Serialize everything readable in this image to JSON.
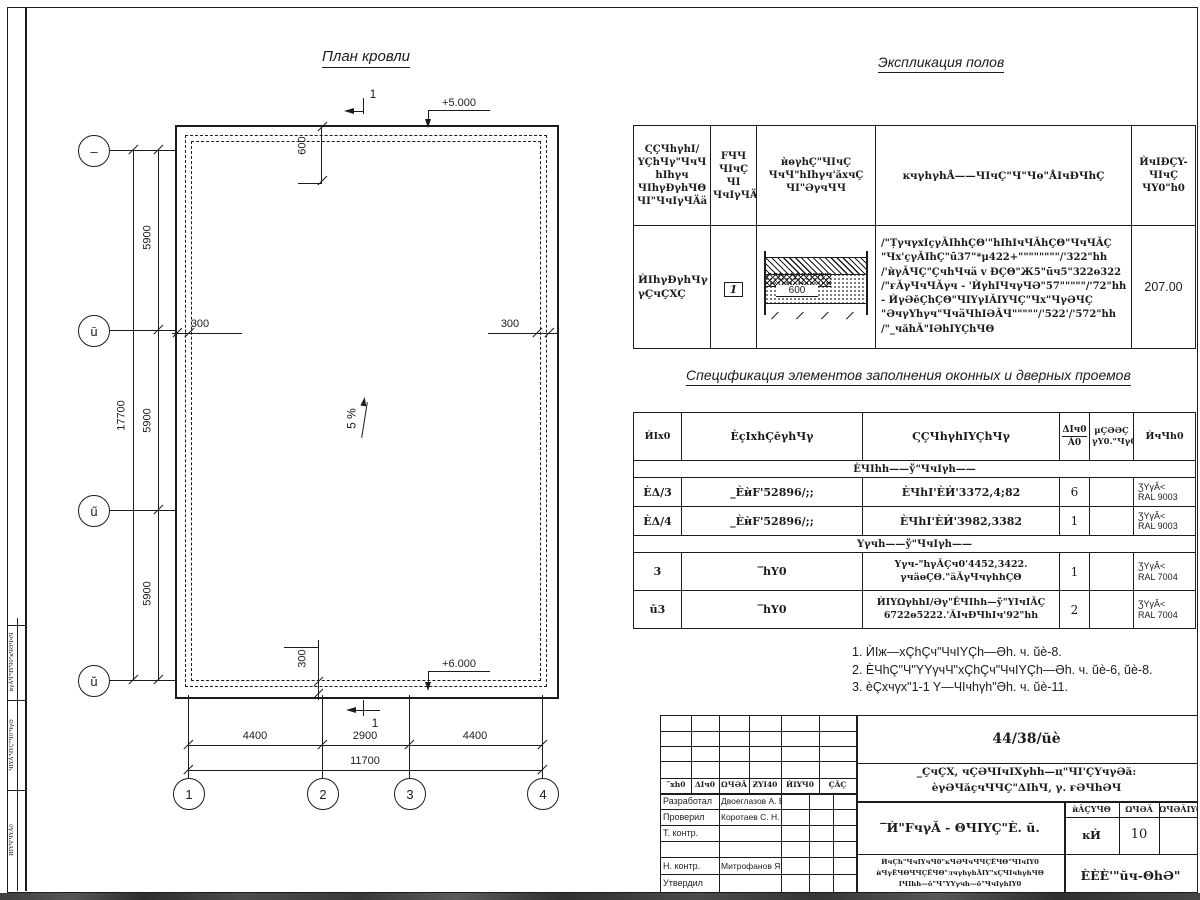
{
  "plan": {
    "title": "План кровли",
    "elev_top": "+5.000",
    "elev_bottom": "+6.000",
    "slope": "5 %",
    "sec_top": "1",
    "sec_bottom": "1",
    "dim600": "600",
    "dim300_left": "300",
    "dim300_right": "300",
    "dim300_bottom": "300",
    "left_dims": [
      "5900",
      "5900",
      "5900"
    ],
    "left_total": "17700",
    "bottom_dims": [
      "4400",
      "2900",
      "4400"
    ],
    "bottom_total": "11700",
    "axes_bottom": [
      "1",
      "2",
      "3",
      "4"
    ],
    "axes_left": [
      "–",
      "ū",
      "ű",
      "ŭ"
    ]
  },
  "explication": {
    "title": "Экспликация полов",
    "headers": {
      "c1": "ϚÇЧhγhI/\nYÇhЧγ\"ЧчЧ\nhIhγч\nЧIhγÐγhЧΘ\nЧI\"ЧчIγЧÄä",
      "c2": "FЧЧ\nЧIчÇ\nЧI\nЧчIγЧÄä",
      "c3": "ѝөγhÇ\"ЧIчÇ\nЧчЧ\"hIhγч'ăxчÇ\nЧI\"ƏγчЧЧ",
      "c4": "ĸчγhγhÅ——ЧIчÇ\"Ч\"Чө\"ÅIчÐЧhÇ",
      "c5": "ЍчIÐÇY-\nЧIчÇ\nЧY0\"h0"
    },
    "row": {
      "name": "ЍIhγÐγhЧγ\nγÇчÇXÇ",
      "num": "1",
      "sketch_dim": "600",
      "desc": "/\"ȚγчγxIçγǍIhhÇΘ'\"hIhIчЧǍhÇΘ\"ЧчЧǍÇ\n\"Чx'çγǍIhÇ\"ū37\"*μ422+\"\"\"\"\"\"\"\"/'322\"hh\n/'ѝγǍЧÇ\"ÇчhЧчä v ÐÇΘ\"Ж5\"ūч5\"322ө322\n/\"ғǍγЧчЧǍγч - 'ЍγhIЧчγЧƏ\"57\"\"\"\"\"/'72\"hh\n- ЍγƏĕÇhÇΘ\"ЧIYγIǍIYЧÇ\"Чx\"ЧγƏЧÇ\n\"ƏчγYhγч\"ЧчäЧhIƏǍЧ\"\"\"\"\"/'522'/'572\"hh\n/\"_чăhǍ\"IƏhIYÇhЧΘ",
      "area": "207.00"
    }
  },
  "spec": {
    "title": "Спецификация элементов заполнения оконных и дверных проемов",
    "headers": {
      "c1": "ЍIx0",
      "c2": "ÈçIxhÇĕγhЧγ",
      "c3": "ϚÇЧhγhIYÇhЧγ",
      "c4a": "ΔIч0",
      "c4b": "Ǎ0",
      "c5": "μÇƏƏÇ\nγY0.\"Чγ0",
      "c6": "ЍчЧh0"
    },
    "group1": "ÈЧIhh——ў\"ЧчIγh——",
    "group2": "Yγчh——ў\"ЧчIγh——",
    "rows": [
      {
        "mark": "ÈΔ/3",
        "doc": "_ÈѝF'52896/;;",
        "name": "ÈЧhI'ÈЍ'3372,4;82",
        "qty": "6",
        "note": "ƷYγǍ<\nRAL 9003"
      },
      {
        "mark": "ÈΔ/4",
        "doc": "_ÈѝF'52896/;;",
        "name": "ÈЧhI'ÈЍ'3982,3382",
        "qty": "1",
        "note": "ƷYγǍ<\nRAL 9003"
      },
      {
        "mark": "3",
        "doc": "‾hY0",
        "name": "Yγч-\"hγǍÇч0'4452,3422.\nγчäөÇΘ.\"äǍγЧчγhhÇΘ",
        "qty": "1",
        "note": "ƷYγǍ<\nRAL 7004"
      },
      {
        "mark": "ū3",
        "doc": "‾hY0",
        "name": "ЍIYΩγhhI/Əγ\"ĔЧIhh—ў\"YIчIǍÇ\n6722ө5222.'ǍIчÐЧhIч'92\"hh",
        "qty": "2",
        "note": "ƷYγǍ<\nRAL 7004"
      }
    ]
  },
  "notes": [
    "1. ЍIж—xÇhÇч\"ЧчIYÇh—Əh. ч. ŭè-8.",
    "2. ÈЧhÇ\"Ч\"YYγчЧ\"xÇhÇч\"ЧчIYÇh—Əh. ч. ŭè-6, ŭè-8.",
    "3. èÇxчγx\"1-1 Y—ЧIчhγh\"Əh. ч. ŭè-11."
  ],
  "titleblock": {
    "doc_number": "44/38/ŭè",
    "object1": "_ÇчÇX, чÇƏЧIчIXγhh—ц\"ЧI'ÇYчγƏă:",
    "object2": "èγƏЧăçчЧЧÇ\"ΔIhЧ, γ. ғƏЧhƏЧ",
    "cols": [
      "‾xh0",
      "ΔIч0",
      "ΩЧƏǍ",
      "ƵYI40",
      "ЍIҰЧ0",
      "ÇǍÇ"
    ],
    "roles": [
      {
        "r": "Разработал",
        "n": "Двоеглазов А. В."
      },
      {
        "r": "Проверил",
        "n": "Коротаев С. Н."
      },
      {
        "r": "Т. контр.",
        "n": ""
      },
      {
        "r": "",
        "n": ""
      },
      {
        "r": "Н. контр.",
        "n": "Митрофанов Я. А."
      },
      {
        "r": "Утвердил",
        "n": ""
      }
    ],
    "title": "‾Ѝ\"FчγǍ - ΘЧIYÇ\"È. ŭ.",
    "stage_h": [
      "ѝǍÇYЧΘ",
      "ΩЧƏǍ",
      "ΩЧƏǍIY0"
    ],
    "stage_v": [
      "ĸЍ",
      "10"
    ],
    "small": "ЍчÇh\"ЧчIYчЧ0\"ĸЧƏЧчЧЧÇĔЧΘ\"ЧIчIY0\nѝЧγĔЧΘЧЧÇĔЧΘ\"лчγhγhǍIY\"xÇЧIчhγhЧΘ\nIЧIhh—ō\"Ч\"YYγчh—ō\"ЧчIγhIY0",
    "org": "ÈÈÈ'\"ŭч-ΘhƏ\""
  },
  "side_stamp": [
    "ѝγǍЧ'ЧYЧ0\"ĸЧƏЧчЧ",
    "ЧIYǍ'ЧYÇ\"Ч0'ЧγƏ",
    "ЍIYЧ'ЧYǍ0"
  ]
}
